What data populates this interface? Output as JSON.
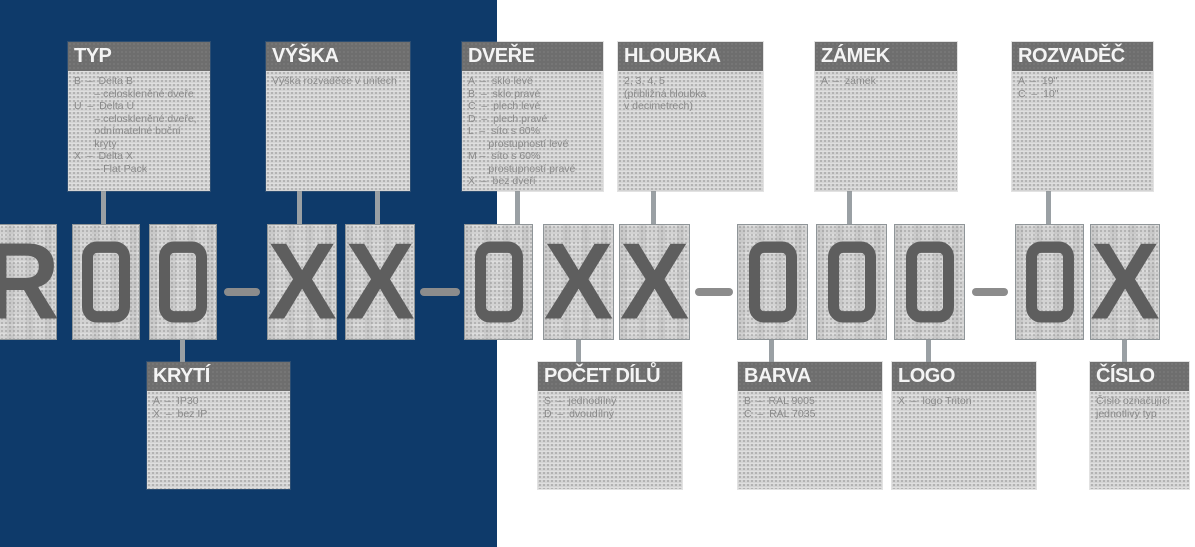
{
  "palette": {
    "navy": "#0e3a6a",
    "box_bg": "#d4d4d4",
    "header_bg": "#6e6e6e",
    "header_text": "#f4f4f4",
    "body_text": "#898989",
    "glyph": "#5e5e5e",
    "connector": "#9aa0a4",
    "dash": "#8c8c8c"
  },
  "code": {
    "full": "R00–XX–0XX–000–0X",
    "chars": [
      "R",
      "0",
      "0",
      "X",
      "X",
      "0",
      "X",
      "X",
      "0",
      "0",
      "0",
      "0",
      "X"
    ],
    "separator": "–"
  },
  "top_boxes": {
    "typ": {
      "title": "TYP",
      "body": "B  –  Delta B\n       – celoskleněné dveře\nU  –  Delta U\n       – celoskleněné dveře,\n       odnímatelné boční\n       kryty\nX  –  Delta X\n       – Flat Pack"
    },
    "vyska": {
      "title": "VÝŠKA",
      "body": "Výška rozvaděče v unitech"
    },
    "dvere": {
      "title": "DVEŘE",
      "body": "A  –  sklo levé\nB  –  sklo pravé\nC  –  plech levé\nD  –  plech pravé\nL  –  síto s 60%\n       prostupností levé\nM –  síto s 60%\n       prostupností pravé\nX  –  bez dveří"
    },
    "hloubka": {
      "title": "HLOUBKA",
      "body": "2, 3, 4, 5\n(přibližná hloubka\nv decimetrech)"
    },
    "zamek": {
      "title": "ZÁMEK",
      "body": "A  –  zámek"
    },
    "rozvadec": {
      "title": "ROZVADĚČ",
      "body": "A  –  19\"\nC  –  10\""
    }
  },
  "bottom_boxes": {
    "kryti": {
      "title": "KRYTÍ",
      "body": "A  –  IP30\nX  –  bez IP"
    },
    "pocet_dilu": {
      "title": "POČET DÍLŮ",
      "body": "S  –  jednodílný\nD  –  dvoudílný"
    },
    "barva": {
      "title": "BARVA",
      "body": "B  –  RAL 9005\nC  –  RAL 7035"
    },
    "logo": {
      "title": "LOGO",
      "body": "X  –  logo Triton"
    },
    "cislo": {
      "title": "ČÍSLO",
      "body": "Číslo označující\njednotlivý typ"
    }
  }
}
